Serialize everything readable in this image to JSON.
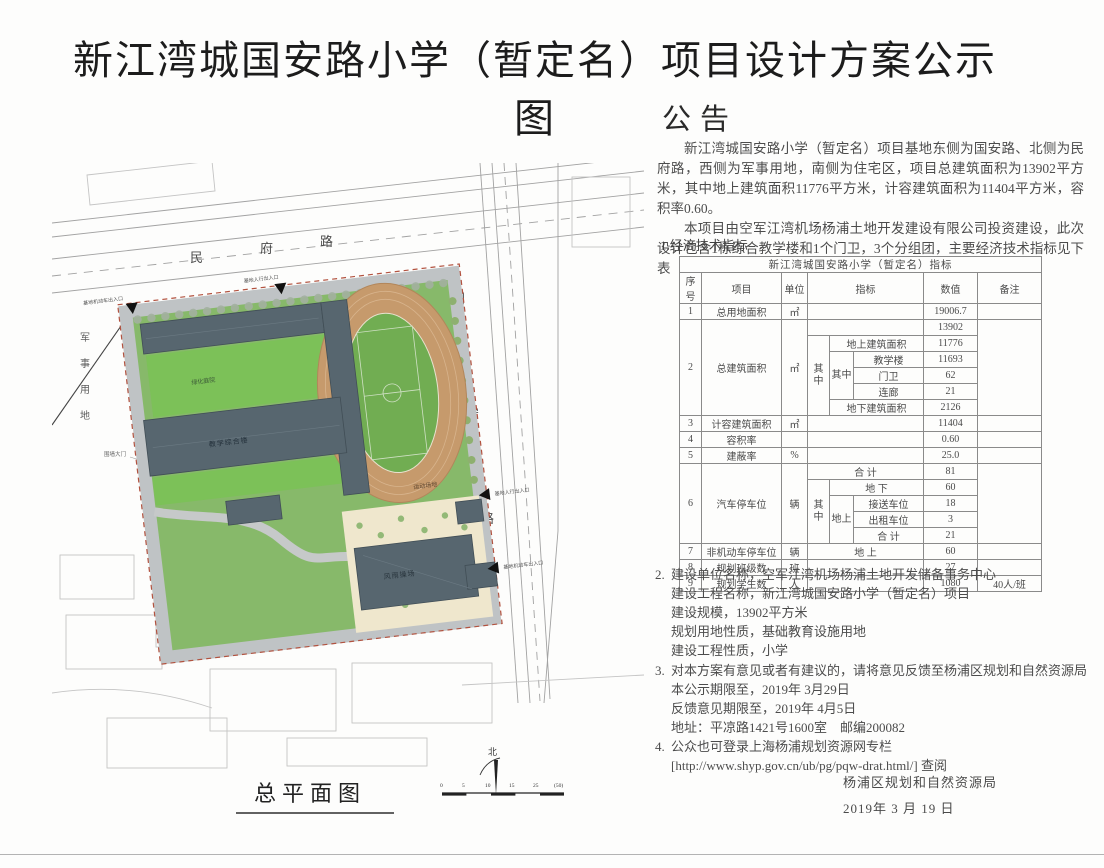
{
  "doc_title": "新江湾城国安路小学（暂定名）项目设计方案公示图",
  "notice": {
    "heading": "公告",
    "p1": "新江湾城国安路小学（暂定名）项目基地东侧为国安路、北侧为民府路，西侧为军事用地，南侧为住宅区，项目总建筑面积为13902平方米，其中地上建筑面积11776平方米，计容建筑面积为11404平方米，容积率0.60。",
    "p2": "本项目由空军江湾机场杨浦土地开发建设有限公司投资建设，此次设计包含1栋综合教学楼和1个门卫，3个分组团，主要经济技术指标见下表"
  },
  "sections": {
    "s1_label": "1.经济技术指标",
    "s2": {
      "mk": "2.",
      "lines": [
        "建设单位名称，空军江湾机场杨浦土地开发储备事务中心",
        "建设工程名称，新江湾城国安路小学（暂定名）项目",
        "建设规模，13902平方米",
        "规划用地性质，基础教育设施用地",
        "建设工程性质，小学"
      ]
    },
    "s3": {
      "mk": "3.",
      "lines": [
        "对本方案有意见或者有建议的，请将意见反馈至杨浦区规划和自然资源局",
        "本公示期限至，2019年 3月29日",
        "反馈意见期限至，2019年 4月5日",
        "地址：平凉路1421号1600室　邮编200082"
      ]
    },
    "s4": {
      "mk": "4.",
      "lines": [
        "公众也可登录上海杨浦规划资源网专栏",
        "[http://www.shyp.gov.cn/ub/pg/pqw-drat.html/] 查阅"
      ]
    }
  },
  "table": {
    "title": "新江湾城国安路小学（暂定名）指标",
    "headers": [
      "序号",
      "项目",
      "单位",
      "指标",
      "数值",
      "备注"
    ],
    "r1": {
      "no": "1",
      "name": "总用地面积",
      "unit": "㎡",
      "value": "19006.7"
    },
    "r2": {
      "no": "2",
      "name": "总建筑面积",
      "unit": "㎡",
      "value": "13902",
      "qz": "其中",
      "sub_up": "地上建筑面积",
      "up_value": "11776",
      "qz2": "其中",
      "b1": "教学楼",
      "v1": "11693",
      "b2": "门卫",
      "v2": "62",
      "b3": "连廊",
      "v3": "21",
      "sub_down": "地下建筑面积",
      "down_value": "2126"
    },
    "r3": {
      "no": "3",
      "name": "计容建筑面积",
      "unit": "㎡",
      "value": "11404"
    },
    "r4": {
      "no": "4",
      "name": "容积率",
      "unit": "",
      "value": "0.60"
    },
    "r5": {
      "no": "5",
      "name": "建蔽率",
      "unit": "%",
      "value": "25.0"
    },
    "r6": {
      "no": "6",
      "name": "汽车停车位",
      "unit": "辆",
      "total_label": "合 计",
      "total": "81",
      "qz": "其中",
      "down_label": "地 下",
      "down": "60",
      "up_label": "地上",
      "s1": "接送车位",
      "sv1": "18",
      "s2": "出租车位",
      "sv2": "3",
      "s3": "合 计",
      "sv3": "21"
    },
    "r7": {
      "no": "7",
      "name": "非机动车停车位",
      "unit": "辆",
      "pos": "地 上",
      "value": "60"
    },
    "r8": {
      "no": "8",
      "name": "规划班级数",
      "unit": "班",
      "value": "27"
    },
    "r9": {
      "no": "9",
      "name": "规划学生数",
      "unit": "人",
      "value": "1080",
      "note": "40人/班"
    }
  },
  "signature": {
    "line1": "杨浦区规划和自然资源局",
    "line2": "2019年 3 月 19 日"
  },
  "plan": {
    "title": "总平面图",
    "road_top_chars": [
      "民",
      "府",
      "路"
    ],
    "road_right_chars": [
      "国",
      "安",
      "路"
    ],
    "military_chars": [
      "军",
      "事",
      "用",
      "地"
    ],
    "gate_label": "围墙大门",
    "courtyard_label": "绿化庭院",
    "building_label_1": "教学综合楼",
    "gym_label": "风雨操场",
    "track_label": "运动场地",
    "entrance_top_left": "基地机动车出入口",
    "entrance_top_right": "基地人行出入口",
    "entrance_right_1": "基地人行出入口",
    "entrance_right_2": "基地机动车出入口",
    "north_label": "北",
    "scale_ticks": [
      "0",
      "5",
      "10",
      "15",
      "25",
      "(50)"
    ]
  },
  "colors": {
    "campus_green": "#87b96a",
    "track_tan": "#c69a6c",
    "building_slate": "#57666f",
    "boundary_red": "#b2523f"
  }
}
